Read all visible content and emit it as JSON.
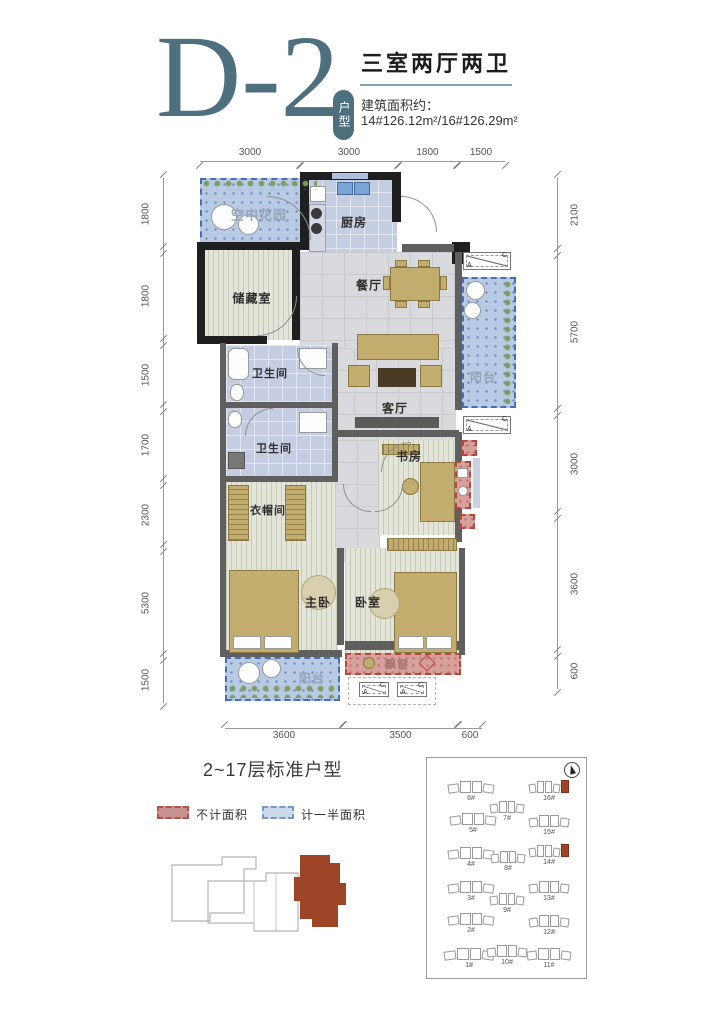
{
  "header": {
    "unit_code": "D-2",
    "unit_badge": "户型",
    "layout_title": "三室两厅两卫",
    "area_label": "建筑面积约：",
    "area_value": "14#126.12m²/16#126.29m²"
  },
  "plan": {
    "dims": {
      "top": [
        "3000",
        "3000",
        "1800",
        "1500"
      ],
      "left": [
        "1800",
        "1800",
        "1500",
        "1700",
        "2300",
        "5300",
        "1500"
      ],
      "right": [
        "2100",
        "5700",
        "3000",
        "3600",
        "600"
      ],
      "bottom": [
        "3600",
        "3500",
        "600"
      ]
    },
    "rooms": {
      "sky_garden": "空中花园",
      "kitchen": "厨房",
      "storage": "储藏室",
      "dining": "餐厅",
      "bath_upper": "卫生间",
      "bath_lower": "卫生间",
      "living": "客厅",
      "balcony_right": "阳台",
      "study": "书房",
      "cloakroom": "衣帽间",
      "master_bedroom": "主卧",
      "bedroom": "卧室",
      "balcony_bottom": "阳台",
      "bay_window": "飘窗"
    },
    "section_marker": {
      "a": "A",
      "c": "C"
    }
  },
  "footer": {
    "floor_note": "2~17层标准户型",
    "legend": {
      "excluded": "不计面积",
      "half": "计一半面积"
    }
  },
  "site_plan": {
    "highlighted_buildings": [
      "16#",
      "14#"
    ],
    "buildings": [
      {
        "id": "6#",
        "x": 44,
        "y": 22,
        "w": 46
      },
      {
        "id": "16#",
        "x": 122,
        "y": 22,
        "w": 40,
        "hl": true
      },
      {
        "id": "7#",
        "x": 80,
        "y": 42,
        "w": 34
      },
      {
        "id": "5#",
        "x": 46,
        "y": 54,
        "w": 46
      },
      {
        "id": "15#",
        "x": 122,
        "y": 56,
        "w": 40
      },
      {
        "id": "4#",
        "x": 44,
        "y": 88,
        "w": 46
      },
      {
        "id": "8#",
        "x": 81,
        "y": 92,
        "w": 34
      },
      {
        "id": "14#",
        "x": 122,
        "y": 86,
        "w": 40,
        "hl": true
      },
      {
        "id": "3#",
        "x": 44,
        "y": 122,
        "w": 46
      },
      {
        "id": "9#",
        "x": 80,
        "y": 134,
        "w": 34
      },
      {
        "id": "13#",
        "x": 122,
        "y": 122,
        "w": 40
      },
      {
        "id": "2#",
        "x": 44,
        "y": 154,
        "w": 46
      },
      {
        "id": "12#",
        "x": 122,
        "y": 156,
        "w": 40
      },
      {
        "id": "1#",
        "x": 42,
        "y": 189,
        "w": 50
      },
      {
        "id": "10#",
        "x": 80,
        "y": 186,
        "w": 40
      },
      {
        "id": "11#",
        "x": 122,
        "y": 189,
        "w": 44
      }
    ]
  },
  "colors": {
    "teal": "#4e6f7e",
    "wall_black": "#1f1f1f",
    "wall_grey": "#5f5f5f",
    "blue_fill": "#b7cce4",
    "blue_border": "#4a6db5",
    "red_fill": "#d8a09a",
    "red_border": "#b5473c",
    "marble": "#d9dadd",
    "plank": "#e3e5d8",
    "bath_floor": "#c5cde2",
    "gold": "#c2ad6e",
    "highlight_red": "#9e4527"
  }
}
